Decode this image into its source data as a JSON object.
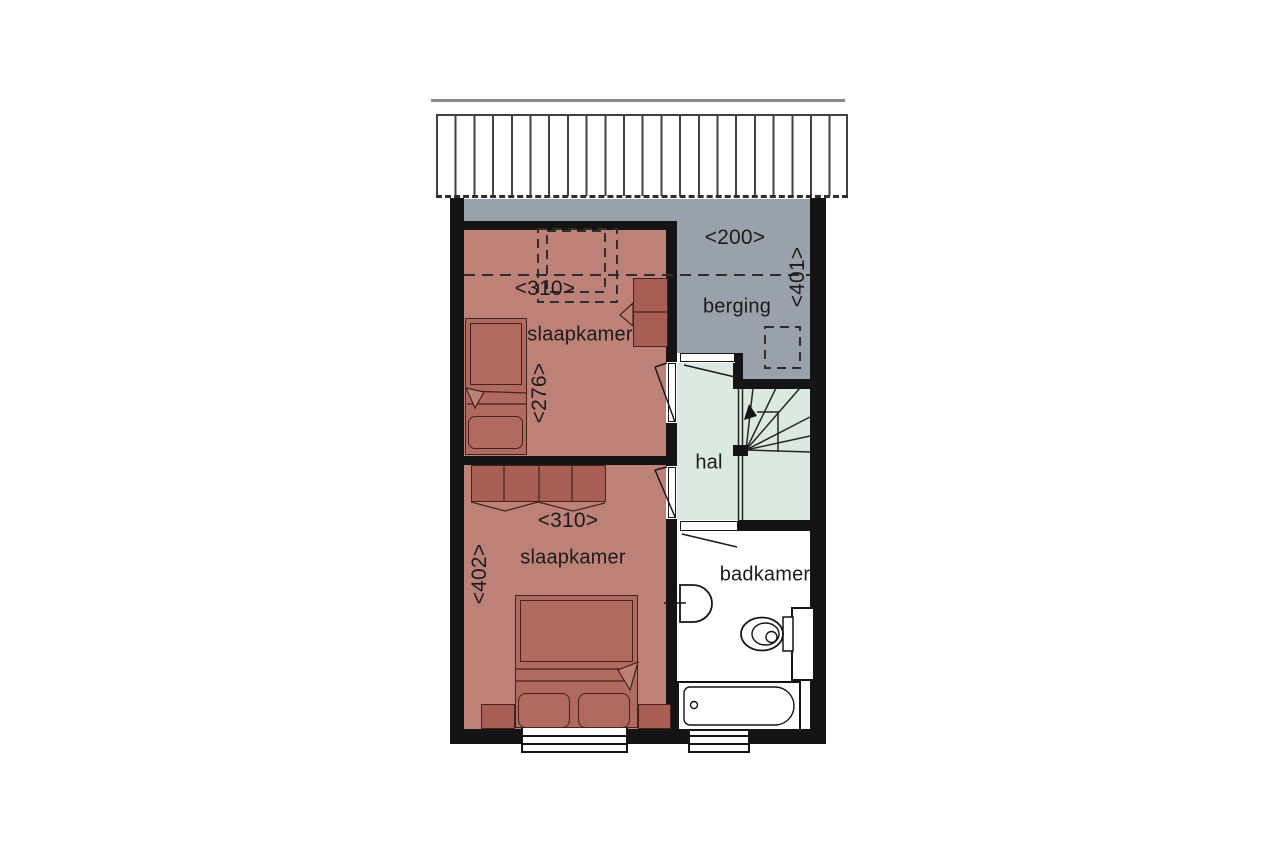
{
  "drawing": {
    "kind": "floor-plan",
    "rooms": [
      {
        "id": "slaapkamer-1",
        "label": "slaapkamer",
        "width_dim": "<310>",
        "depth_dim": "<276>"
      },
      {
        "id": "slaapkamer-2",
        "label": "slaapkamer",
        "width_dim": "<310>",
        "depth_dim": "<402>"
      },
      {
        "id": "berging",
        "label": "berging",
        "width_dim": "<200>",
        "depth_dim": "<401>"
      },
      {
        "id": "hal",
        "label": "hal"
      },
      {
        "id": "badkamer",
        "label": "badkamer"
      }
    ],
    "colors": {
      "wall": "#141414",
      "bedroom_floor": "#bd8177",
      "furniture": "#b06a60",
      "furniture_dark": "#a85e54",
      "storage_floor": "#99a2aa",
      "hall_floor": "#dce8e2",
      "bathroom_floor": "#ffffff",
      "linework": "#2e2e2e",
      "roof_line": "#8b8b8b"
    }
  }
}
